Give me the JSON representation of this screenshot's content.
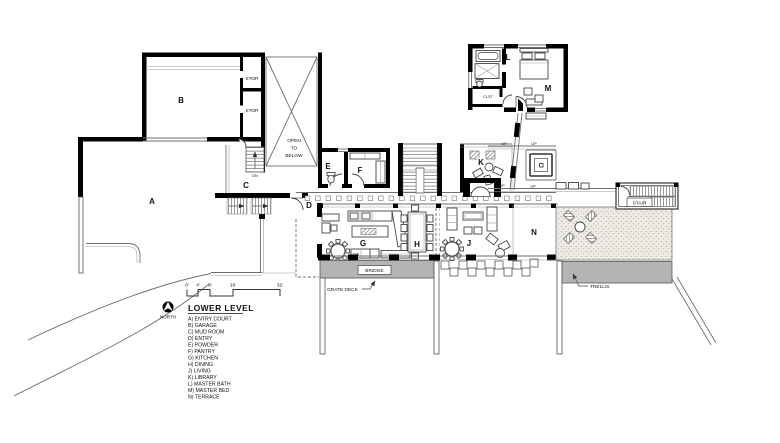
{
  "plan": {
    "room_labels": {
      "a": "A",
      "b": "B",
      "c": "C",
      "d": "D",
      "e": "E",
      "f": "F",
      "g": "G",
      "h": "H",
      "j": "J",
      "k": "K",
      "l": "L",
      "m": "M",
      "n": "N"
    },
    "annotations": {
      "stor": "STOR",
      "clst": "CLST",
      "open_1": "OPEN",
      "open_2": "TO",
      "open_3": "BELOW",
      "stair": "STAIR",
      "bridge": "BRIDGE",
      "grate_deck": "GRATE DECK",
      "trellis": "TRELLIS",
      "dw": "DW",
      "up": "UP",
      "dn": "DN"
    }
  },
  "legend": {
    "north_label": "NORTH",
    "title": "LOWER LEVEL",
    "items": [
      "A) ENTRY COURT",
      "B) GARAGE",
      "C) MUD ROOM",
      "D) ENTRY",
      "E) POWDER",
      "F) PANTRY",
      "G) KITCHEN",
      "H) DINING",
      "J) LIVING",
      "K) LIBRARY",
      "L) MASTER BATH",
      "M) MASTER BED",
      "N) TERRACE"
    ]
  },
  "scale_bar": {
    "ticks": [
      "0'",
      "4'",
      "8'",
      "16'",
      "32'"
    ]
  },
  "colors": {
    "wall": "#000000",
    "line": "#6e6e6e",
    "deck_gray": "#b4b4b4",
    "paper": "#ffffff"
  }
}
